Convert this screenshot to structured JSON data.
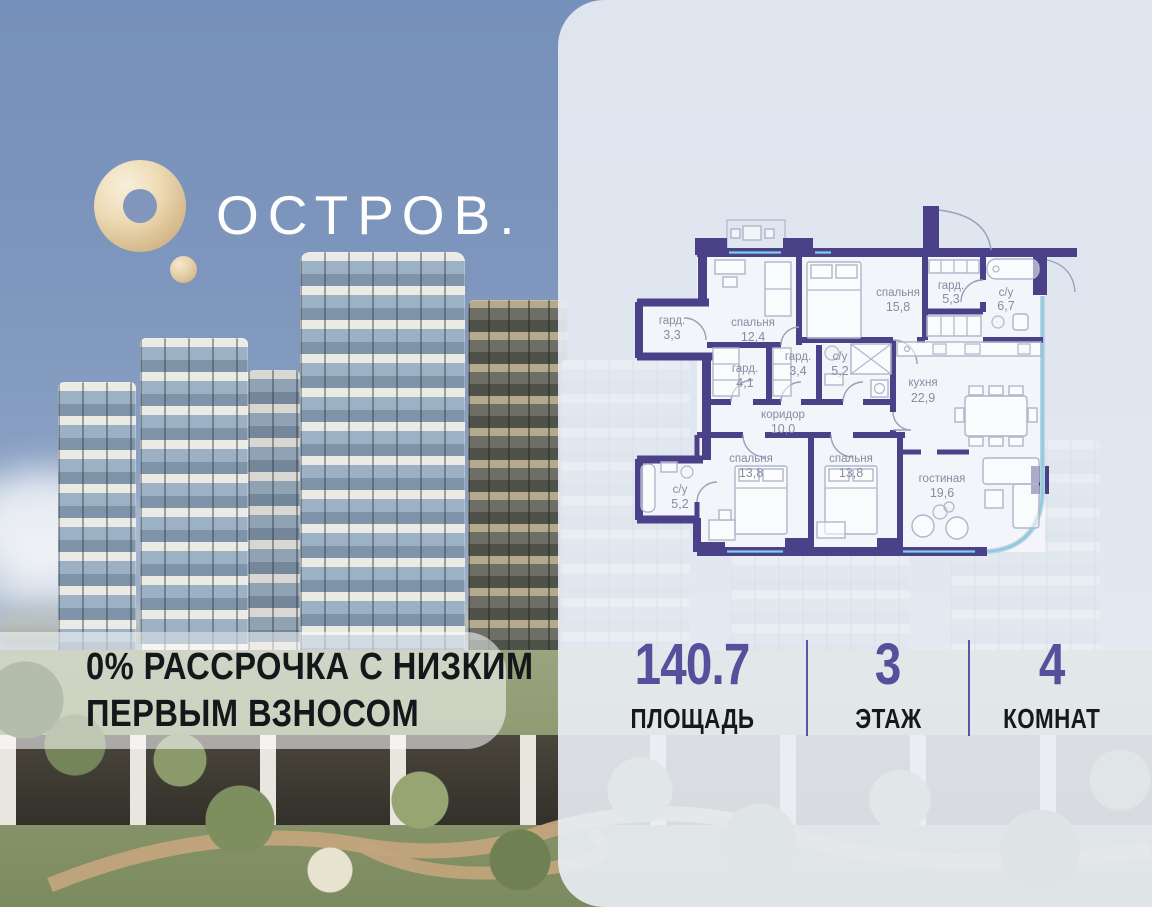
{
  "brand": {
    "wordmark": "ОСТРОВ.",
    "logo_icon": "gold-ring-logo"
  },
  "promo": {
    "line1": "0% РАССРОЧКА С НИЗКИМ",
    "line2": "ПЕРВЫМ ВЗНОСОМ"
  },
  "stats": [
    {
      "value": "140.7",
      "label": "ПЛОЩАДЬ"
    },
    {
      "value": "3",
      "label": "ЭТАЖ"
    },
    {
      "value": "4",
      "label": "КОМНАТ"
    }
  ],
  "floorplan": {
    "rooms": [
      {
        "name": "гард.",
        "area": "3,3"
      },
      {
        "name": "спальня",
        "area": "12,4"
      },
      {
        "name": "спальня",
        "area": "15,8"
      },
      {
        "name": "гард.",
        "area": "5,3"
      },
      {
        "name": "с/у",
        "area": "6,7"
      },
      {
        "name": "гард.",
        "area": "4,1"
      },
      {
        "name": "гард.",
        "area": "3,4"
      },
      {
        "name": "с/у",
        "area": "5,2"
      },
      {
        "name": "кухня",
        "area": "22,9"
      },
      {
        "name": "коридор",
        "area": "10,0"
      },
      {
        "name": "спальня",
        "area": "13,8"
      },
      {
        "name": "спальня",
        "area": "13,8"
      },
      {
        "name": "гостиная",
        "area": "19,6"
      },
      {
        "name": "с/у",
        "area": "5,2"
      }
    ]
  },
  "colors": {
    "accent_purple": "#564f9c",
    "wall_purple": "#4a4189",
    "window_cyan": "#7ed0e8",
    "brand_gold": "#d9bf92",
    "panel": "#eaeef5"
  }
}
